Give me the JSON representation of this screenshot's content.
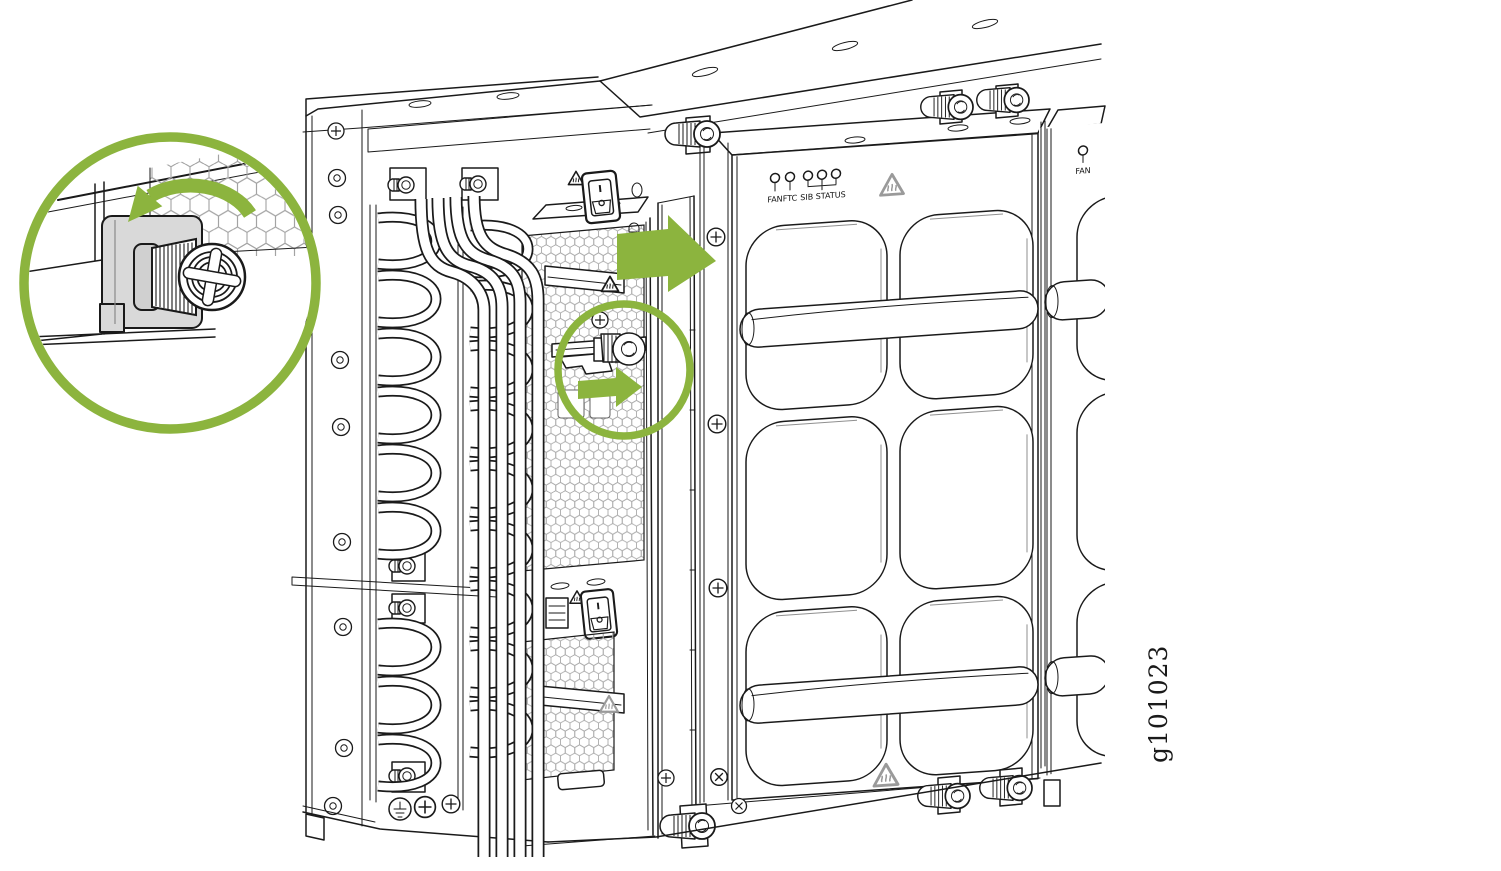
{
  "figure_id": "g101023",
  "colors": {
    "accent_green": "#8CB43E",
    "line": "#1A1A1A",
    "mesh": "#A9A9A9",
    "metal_gray": "#D9D9D9"
  },
  "fan_tray_primary": {
    "led_fan": "FAN",
    "led_ftc": "FTC",
    "led_group": "SIB STATUS"
  },
  "fan_tray_adjacent": {
    "led_fan": "FAN"
  }
}
